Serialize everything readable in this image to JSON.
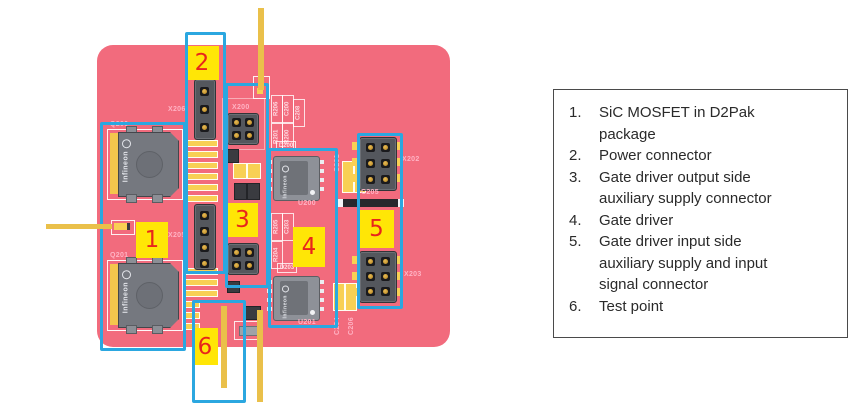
{
  "colors": {
    "board_pink": "#f26b7d",
    "highlight_yellow": "#ffe606",
    "callout_red": "#e8251c",
    "outline_blue": "#2ba7e0",
    "trace_gold": "#eac04a",
    "pad_yellow": "#f8d054",
    "silkscreen_pink": "#ffb3c4"
  },
  "board": {
    "designators": {
      "q200": "Q200",
      "q201": "Q201",
      "x206": "X206",
      "x205": "X205",
      "x200": "X200",
      "x202": "X202",
      "x203": "X203",
      "u200": "U200",
      "u201": "U201",
      "c201": "C201",
      "c204": "C204",
      "c205": "C205",
      "c206": "C206",
      "d200": "D200",
      "d203": "D203"
    },
    "cluster_top": [
      "R206",
      "C200",
      "C208",
      "R201",
      "R200"
    ],
    "cluster_bottom": [
      "R205",
      "C203",
      "R204"
    ],
    "mosfet_brand": "Infineon",
    "ic_brand": "Infineon"
  },
  "callouts": [
    "1",
    "2",
    "3",
    "4",
    "5",
    "6"
  ],
  "legend": {
    "items": [
      {
        "num": "1.",
        "text": "SiC MOSFET in D2Pak package"
      },
      {
        "num": "2.",
        "text": "Power connector"
      },
      {
        "num": "3.",
        "text": "Gate driver output side auxiliary supply connector"
      },
      {
        "num": "4.",
        "text": "Gate driver"
      },
      {
        "num": "5.",
        "text": "Gate driver input side auxiliary supply and input signal connector"
      },
      {
        "num": "6.",
        "text": "Test point"
      }
    ]
  }
}
